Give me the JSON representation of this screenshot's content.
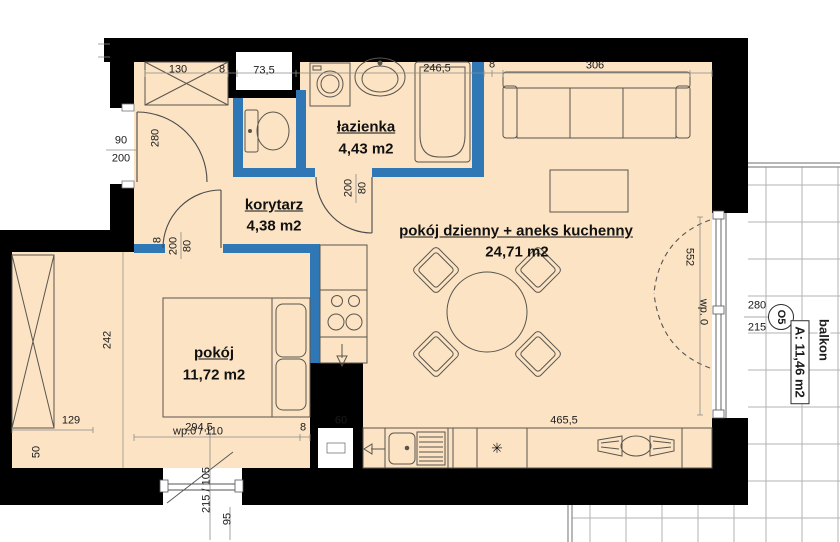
{
  "plan": {
    "title": "apartment floor plan",
    "rooms": [
      {
        "name": "łazienka",
        "area": "4,43 m2"
      },
      {
        "name": "korytarz",
        "area": "4,38 m2"
      },
      {
        "name": "pokój dzienny + aneks kuchenny",
        "area": "24,71 m2"
      },
      {
        "name": "pokój",
        "area": "11,72 m2"
      }
    ],
    "balcony": {
      "name": "balkon",
      "area": "A: 11,46 m2",
      "window_width": "280",
      "window_height": "215",
      "window_symbol": "O5"
    },
    "dims": {
      "top": [
        "130",
        "8",
        "73,5",
        "246,5",
        "8",
        "306"
      ],
      "entrance": {
        "width": "90",
        "height": "200"
      },
      "hall_depth": "280",
      "bath_door": {
        "height": "200",
        "width": "80"
      },
      "bedroom_door": {
        "width": "80",
        "height": "200"
      },
      "partition": "8",
      "bedroom_wall": "8",
      "bedroom": {
        "width": "294,5",
        "depth": "242",
        "alcove_width": "129",
        "alcove_offset": "50"
      },
      "kitchen": {
        "niche": "60",
        "counter": "465,5"
      },
      "balcony_opening": "552"
    },
    "windows": {
      "bottom": {
        "label": "wp.0 / 110",
        "size": "215 / 105",
        "offset": "95"
      },
      "right": {
        "label": "wp. 0"
      }
    },
    "symbols": {
      "star": "✳"
    },
    "colors": {
      "floor": "#fbe3c4",
      "wall": "#000000",
      "partition": "#2f77b5",
      "balcony_grid": "#b3b3b3",
      "furniture_line": "#5a564e"
    }
  }
}
